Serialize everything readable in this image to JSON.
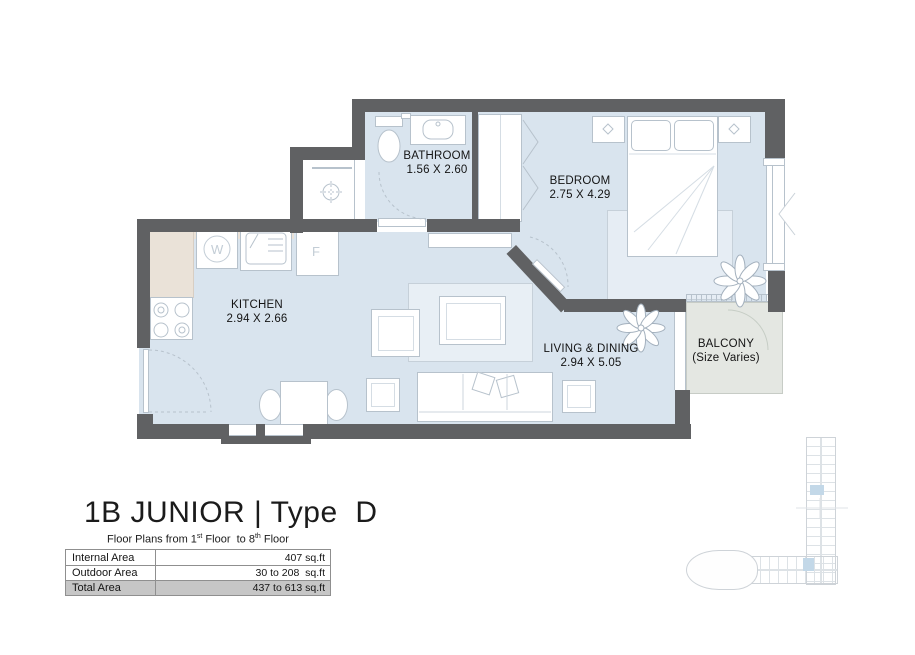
{
  "plan": {
    "rooms": {
      "bathroom": {
        "name": "BATHROOM",
        "dims": "1.56 X 2.60"
      },
      "bedroom": {
        "name": "BEDROOM",
        "dims": "2.75 X 4.29"
      },
      "kitchen": {
        "name": "KITCHEN",
        "dims": "2.94 X 2.66"
      },
      "living": {
        "name": "LIVING & DINING",
        "dims": "2.94 X 5.05"
      },
      "balcony": {
        "name": "BALCONY",
        "note": "(Size Varies)"
      }
    },
    "appliances": {
      "washer": "W",
      "fridge": "F"
    }
  },
  "title_block": {
    "title": "1B JUNIOR | Type  D",
    "subtitle": {
      "pre": "Floor Plans from ",
      "n1": "1",
      "s1": "st",
      "mid": " Floor  to ",
      "n2": "8",
      "s2": "th",
      "post": " Floor"
    },
    "table": {
      "rows": [
        {
          "label": "Internal Area",
          "value": "407 sq.ft"
        },
        {
          "label": "Outdoor Area",
          "value": "30 to 208  sq.ft"
        },
        {
          "label": "Total Area",
          "value": "437 to 613 sq.ft"
        }
      ]
    }
  },
  "colors": {
    "wall": "#606163",
    "floor": "#d9e4ee",
    "balcony_floor": "#e4e7e2",
    "counter": "#eae2d8",
    "keyplan_highlight": "#c3d8e8"
  }
}
